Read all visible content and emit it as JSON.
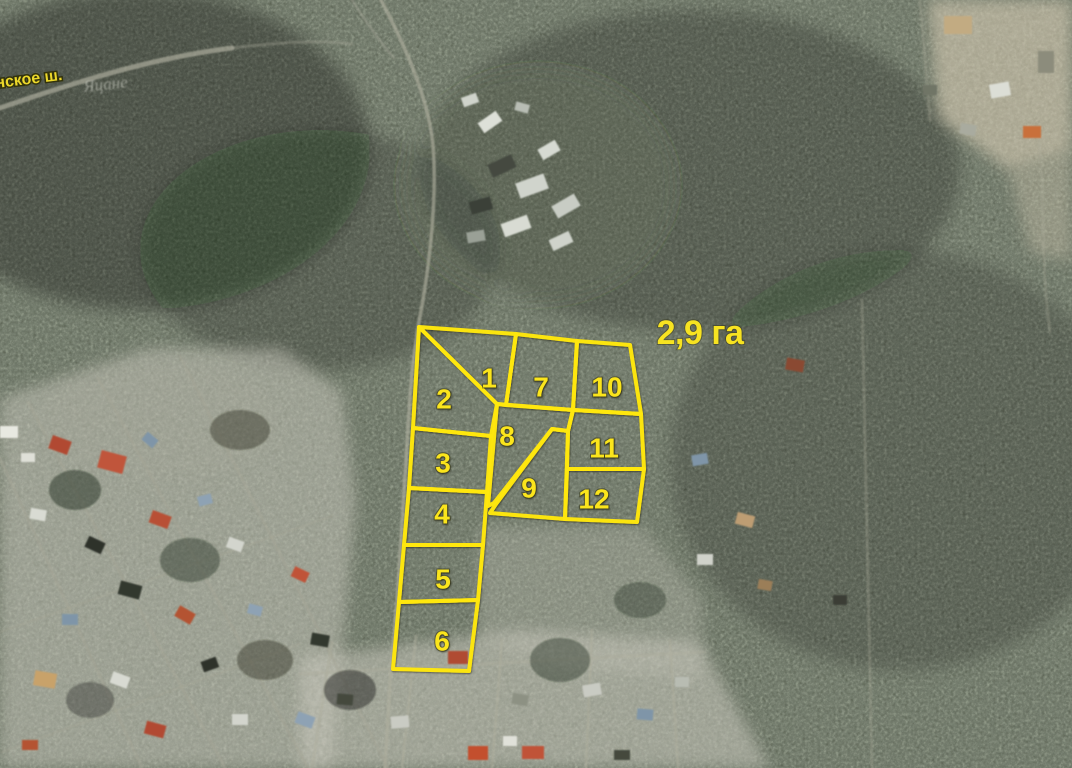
{
  "map": {
    "area_label": "2,9 га",
    "road_label": "нское ш.",
    "place_label": "Яцане",
    "plots": [
      {
        "label": "1",
        "outline": "419,327 516,334 506,405 497,404",
        "lx": 489,
        "ly": 378
      },
      {
        "label": "2",
        "outline": "419,327 497,404 491,436 413,428",
        "lx": 444,
        "ly": 399
      },
      {
        "label": "3",
        "outline": "413,428 491,436 487,492 409,488",
        "lx": 443,
        "ly": 463
      },
      {
        "label": "4",
        "outline": "409,488 487,492 483,545 404,545",
        "lx": 442,
        "ly": 514
      },
      {
        "label": "5",
        "outline": "404,545 483,545 478,600 399,602",
        "lx": 443,
        "ly": 579
      },
      {
        "label": "6",
        "outline": "399,602 478,600 469,671 393,669",
        "lx": 442,
        "ly": 641
      },
      {
        "label": "7",
        "outline": "516,334 577,341 573,410 506,405",
        "lx": 541,
        "ly": 387
      },
      {
        "label": "8",
        "outline": "497,404 573,410 568,431 552,429 494,503 488,506",
        "lx": 507,
        "ly": 436
      },
      {
        "label": "9",
        "outline": "552,429 568,431 565,519 490,513 496,504",
        "lx": 529,
        "ly": 488
      },
      {
        "label": "10",
        "outline": "577,341 630,345 641,414 573,410",
        "lx": 607,
        "ly": 387
      },
      {
        "label": "11",
        "outline": "573,410 641,414 644,469 567,469 568,431",
        "lx": 604,
        "ly": 448
      },
      {
        "label": "12",
        "outline": "567,469 644,469 637,522 565,519",
        "lx": 594,
        "ly": 499
      }
    ]
  },
  "colors": {
    "plot_outline": "#ffe70d",
    "plot_number": "#fbe51a",
    "area_label": "#f7e321",
    "road_label": "#ecd82b",
    "place_label": "#d6d7cd"
  }
}
